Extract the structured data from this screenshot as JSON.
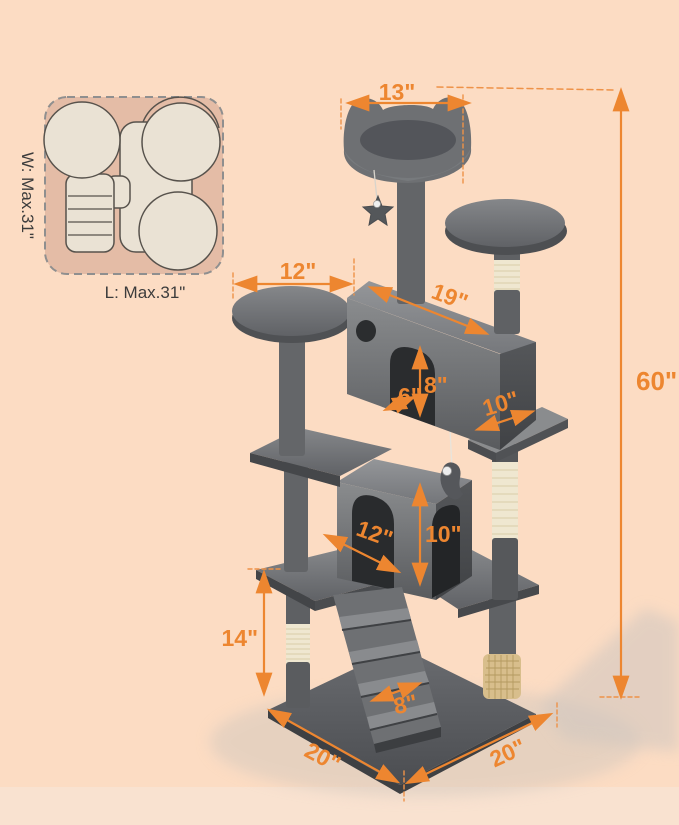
{
  "title": {
    "text": "Ideal Cats Weight: 31lb"
  },
  "top_view": {
    "width_label": "W: Max.31\"",
    "length_label": "L: Max.31\""
  },
  "dimensions": {
    "top_perch_width": "13\"",
    "overall_height": "60\"",
    "upper_platform_width": "12\"",
    "upper_condo_length": "19\"",
    "upper_condo_door_width": "6\"",
    "upper_condo_door_height": "8\"",
    "upper_condo_depth": "10\"",
    "lower_condo_width": "12\"",
    "lower_condo_height": "10\"",
    "lower_section_height": "14\"",
    "ramp_width": "8\"",
    "base_side_left": "20\"",
    "base_side_right": "20\""
  },
  "colors": {
    "background": "#FCDCC3",
    "accent_orange": "#ED8630",
    "title_orange": "#F2914C",
    "tree_gray": "#5B5D60",
    "sisal_cream": "#EFE7D0",
    "groomer_tan": "#D8BE8C",
    "top_view_fill": "#E4BCA6"
  }
}
